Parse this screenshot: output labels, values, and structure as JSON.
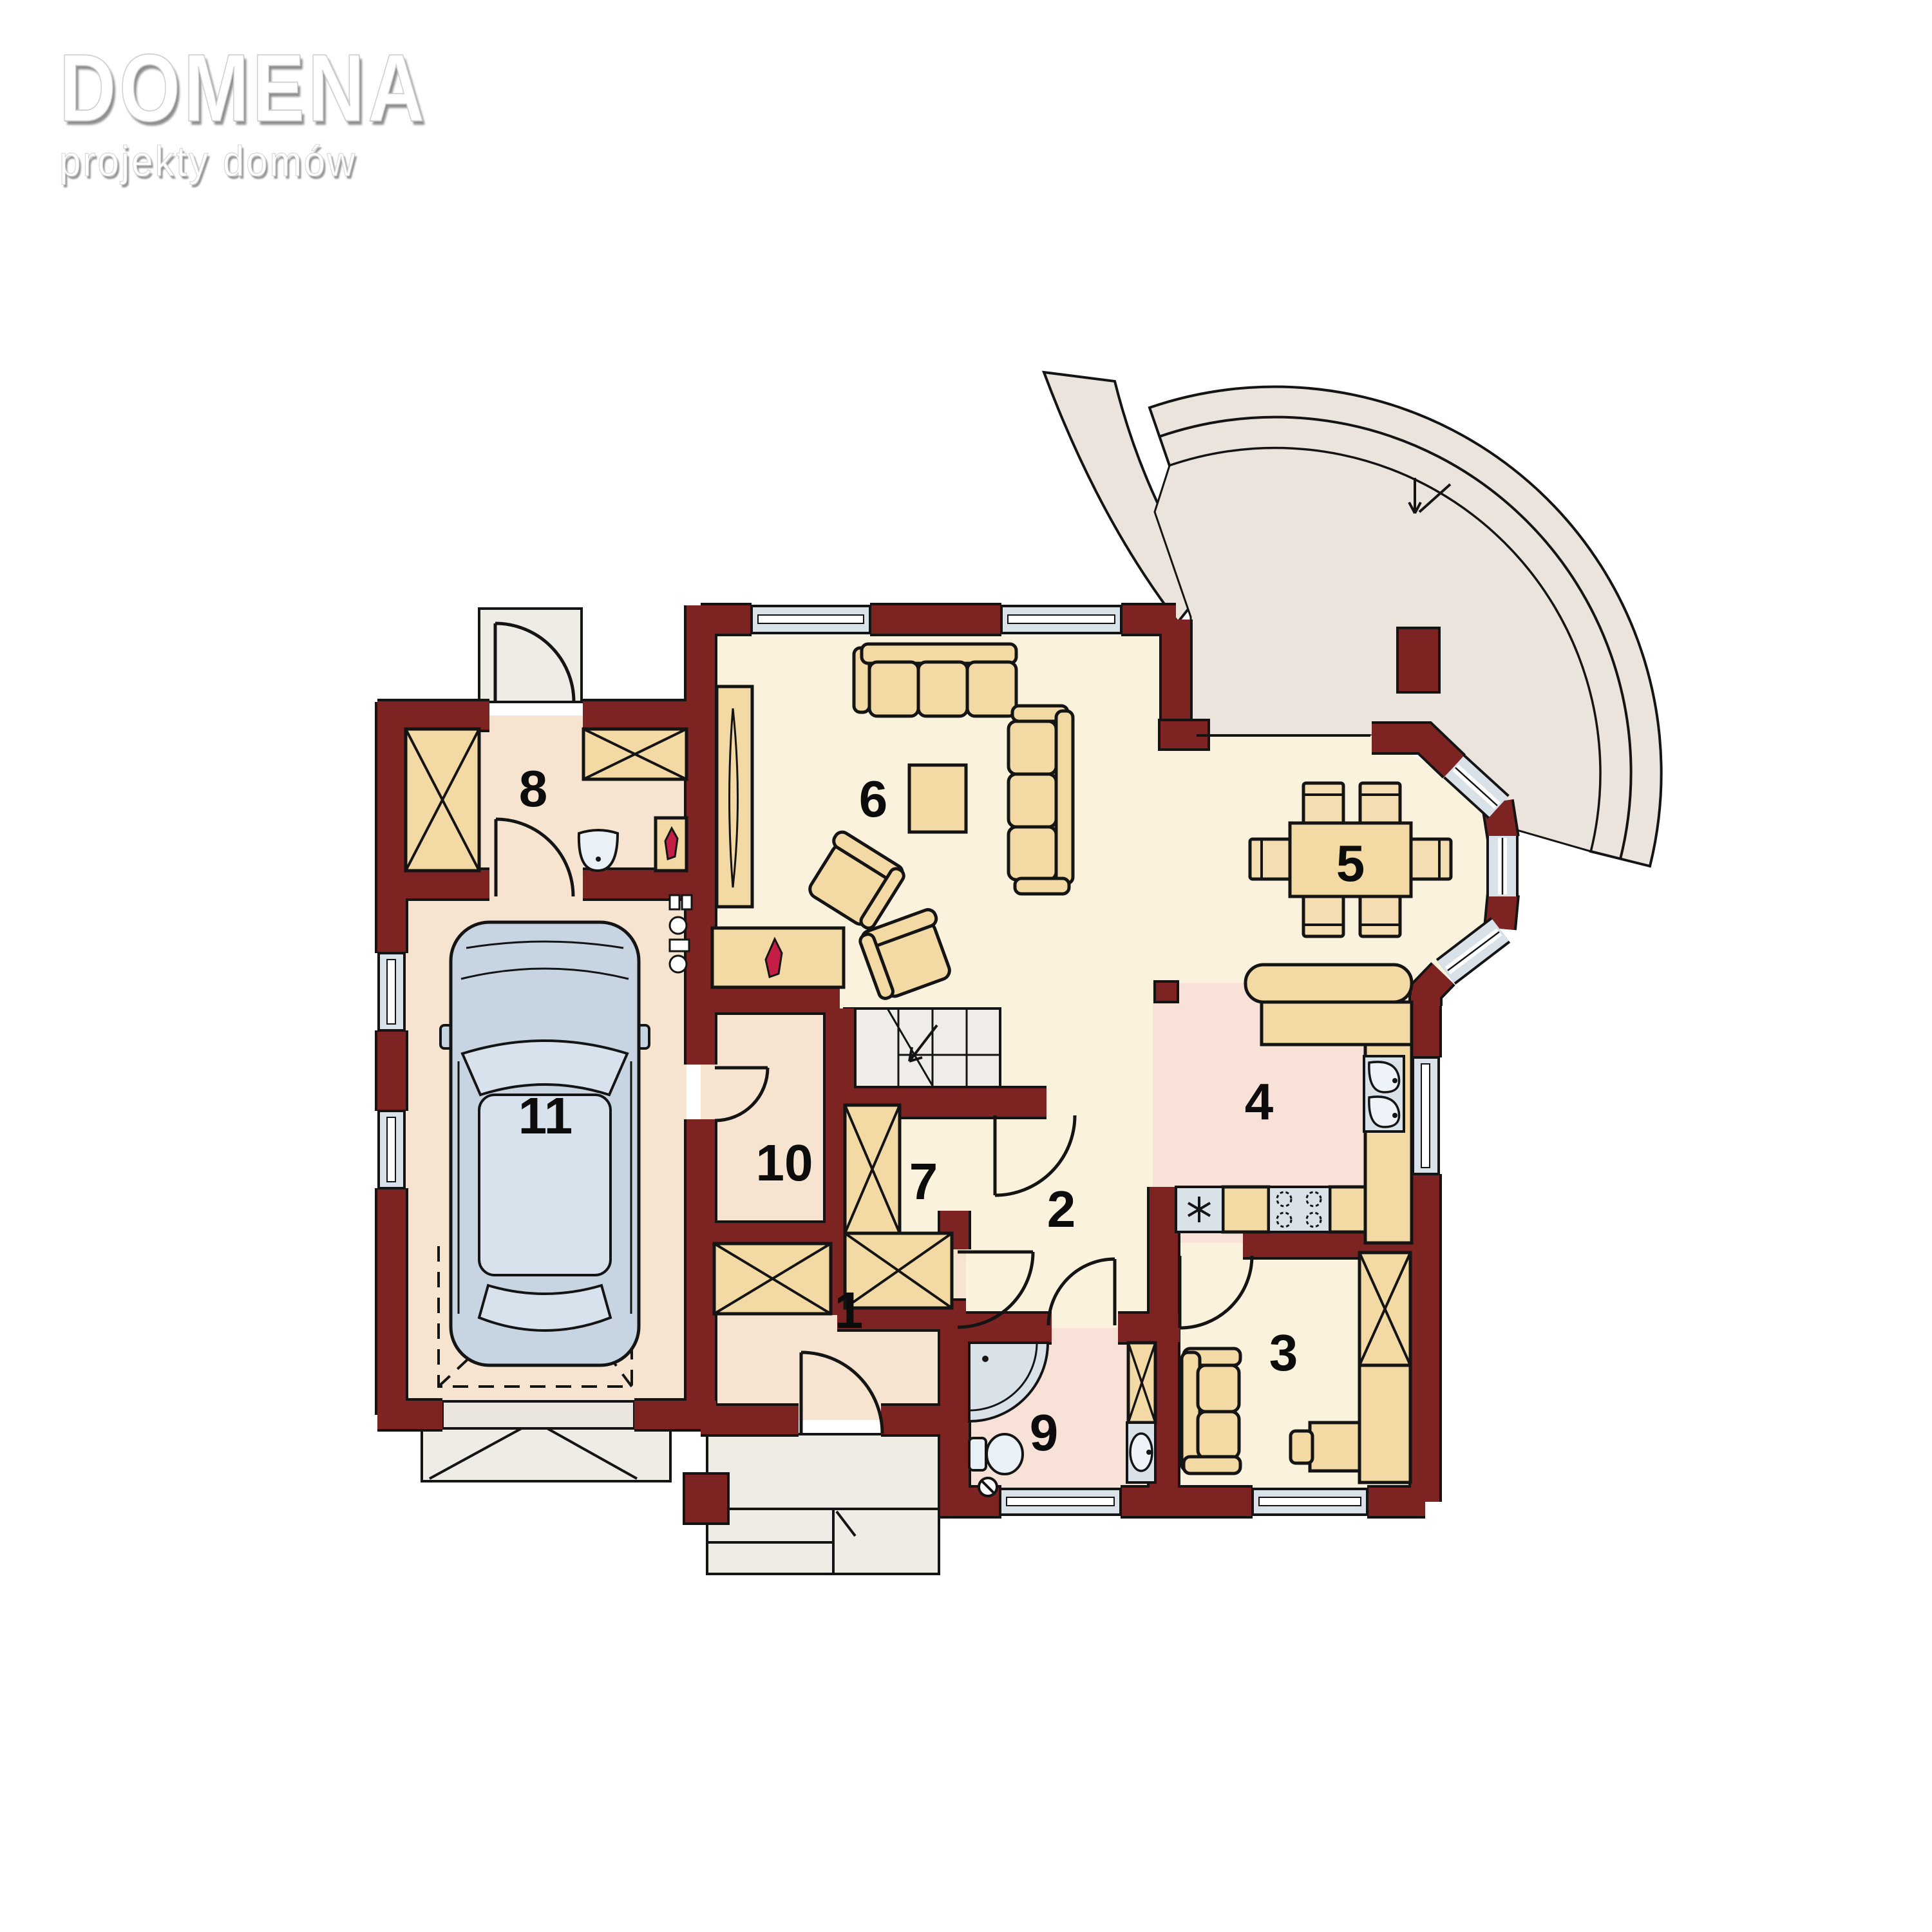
{
  "logo": {
    "title": "DOMENA",
    "subtitle": "projekty domów"
  },
  "plan": {
    "kind": "house-ground-floor-plan",
    "room_numbers": [
      "1",
      "2",
      "3",
      "4",
      "5",
      "6",
      "7",
      "8",
      "9",
      "10",
      "11"
    ],
    "rooms": [
      {
        "label": "1",
        "x": "1318",
        "y": "2062"
      },
      {
        "label": "2",
        "x": "1648",
        "y": "1905"
      },
      {
        "label": "3",
        "x": "1993",
        "y": "2128"
      },
      {
        "label": "4",
        "x": "1955",
        "y": "1738"
      },
      {
        "label": "5",
        "x": "2097",
        "y": "1368"
      },
      {
        "label": "6",
        "x": "1356",
        "y": "1268"
      },
      {
        "label": "7",
        "x": "1434",
        "y": "1862"
      },
      {
        "label": "8",
        "x": "828",
        "y": "1252"
      },
      {
        "label": "9",
        "x": "1621",
        "y": "2252"
      },
      {
        "label": "10",
        "x": "1218",
        "y": "1833"
      },
      {
        "label": "11",
        "x": "847",
        "y": "1760"
      }
    ],
    "colors": {
      "wall": "#7D2423",
      "outline": "#141414",
      "floor_cream": "#FAF2DC",
      "floor_peach": "#F6E4D0",
      "floor_pink": "#F8E2D7",
      "furniture_tan": "#F3D9A4",
      "furniture_tan_light": "#F4DDB0",
      "window_glass": "#D9E1E9",
      "terrace_gray": "#EAE4DD",
      "steps_gray": "#EFEBE5",
      "stairs_gray": "#F0EDE8",
      "car_body": "#C7D5E3",
      "car_roof": "#D8E2ED",
      "flame_red": "#C41E45"
    }
  }
}
